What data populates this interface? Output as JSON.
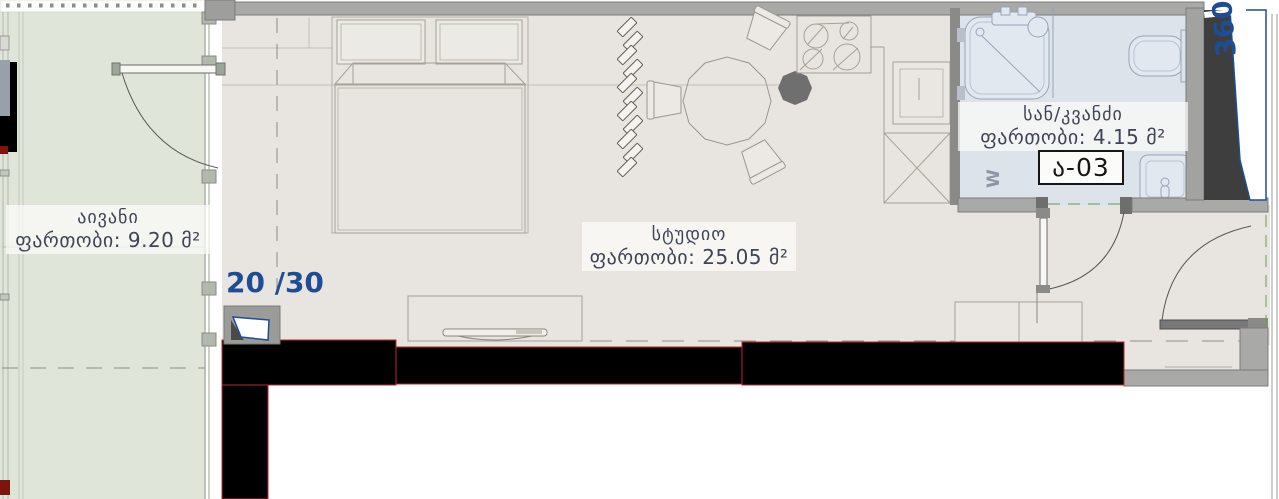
{
  "plan": {
    "rooms": {
      "balcony": {
        "name": "აივანი",
        "area": "ფართობი: 9.20 მ²"
      },
      "studio": {
        "name": "სტუდიო",
        "area": "ფართობი: 25.05 მ²"
      },
      "bathroom": {
        "name": "სან/კვანძი",
        "area": "ფართობი: 4.15 მ²"
      }
    },
    "apartment_code": "ა-03",
    "view_counter": "20 /30",
    "pano_marker": "360",
    "washer": "W"
  },
  "colors": {
    "studio_floor": "#e8e4df",
    "balcony_floor": "#e0e5da",
    "bathroom_floor": "#dce3ea",
    "wall_gray": "#a9a9a8",
    "wall_black": "#000000",
    "outline_red": "#c1272d",
    "accent_blue": "#1d4d95",
    "label_text": "#3f4456"
  }
}
